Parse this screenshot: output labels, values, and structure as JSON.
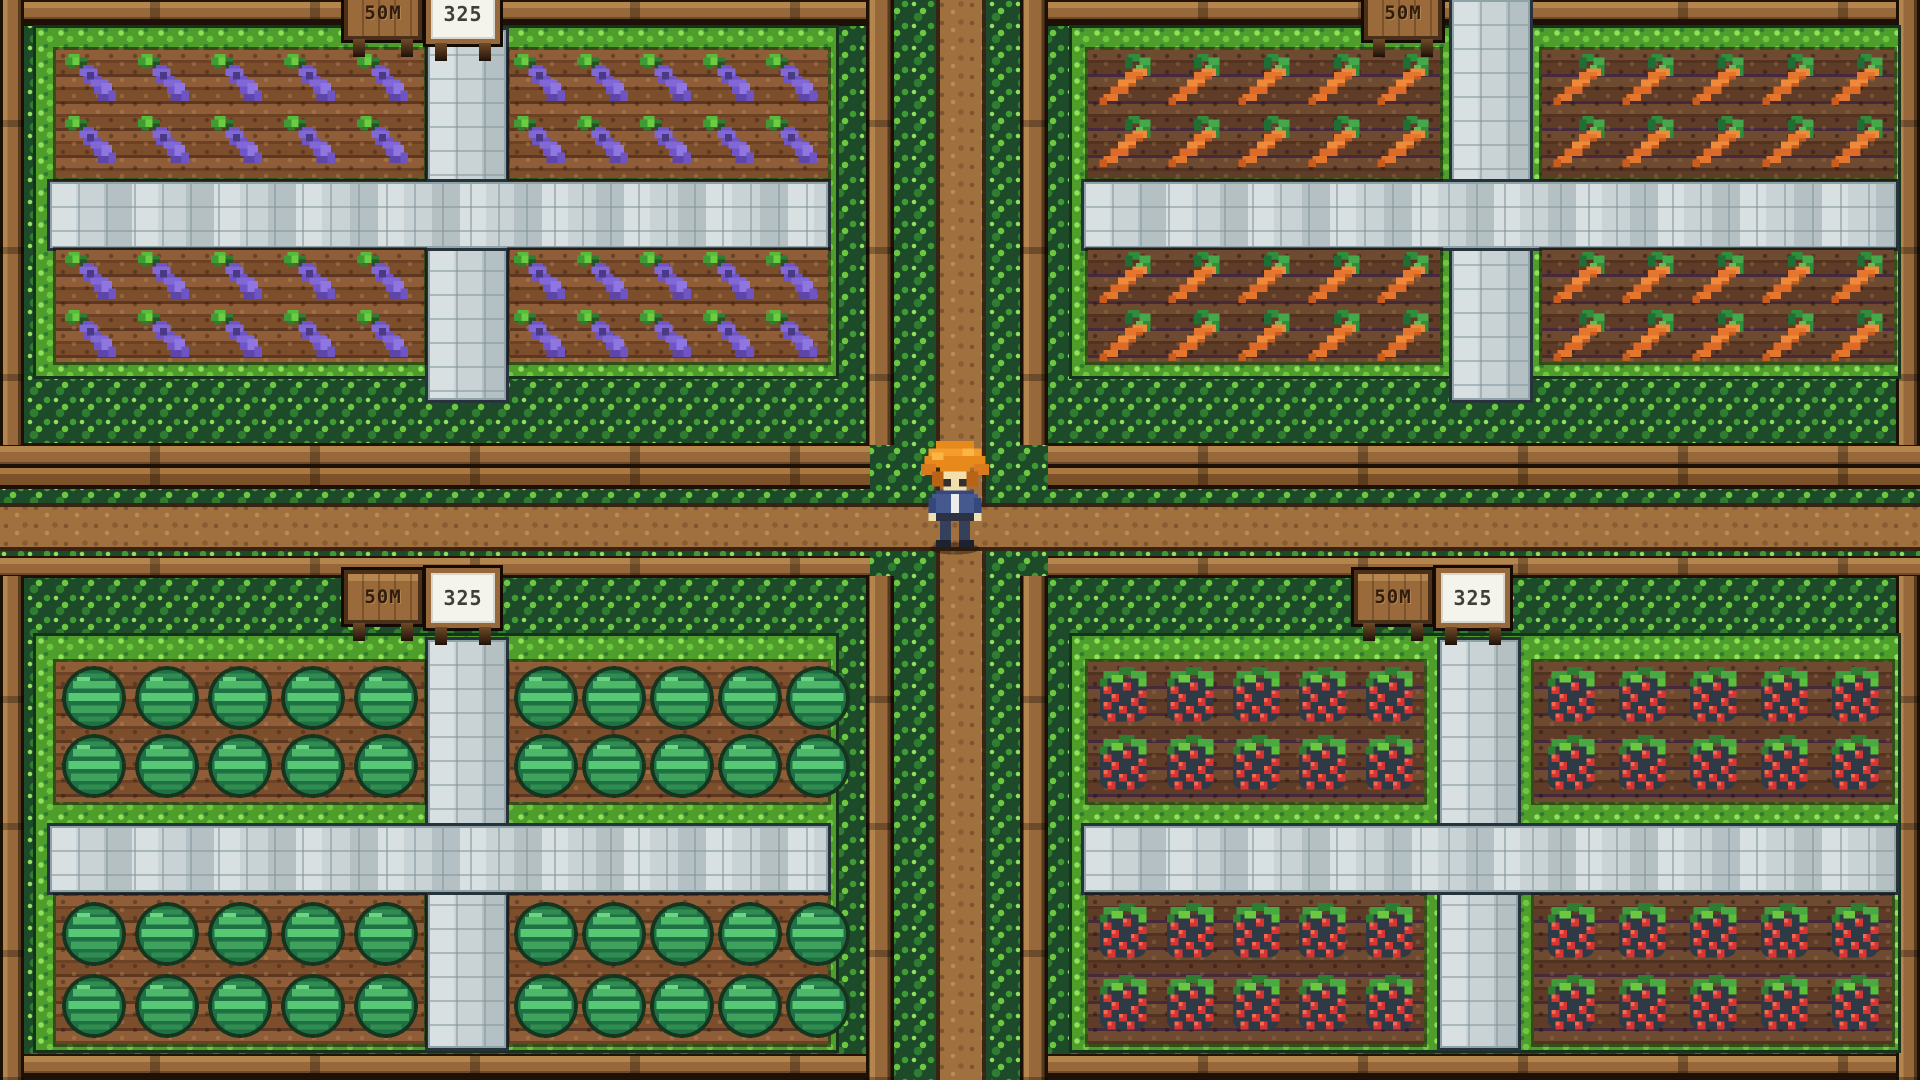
{
  "scene": {
    "type": "farming-game",
    "field_grid": {
      "subplots_per_quadrant": 4,
      "rows_per_subplot": 2,
      "cols_per_subplot": 5
    },
    "quadrants": [
      {
        "id": "top-left",
        "crop": "eggplant",
        "sign_time": "50M",
        "sign_price": "325"
      },
      {
        "id": "top-right",
        "crop": "carrot",
        "sign_time": "50M"
      },
      {
        "id": "bottom-left",
        "crop": "watermelon",
        "sign_time": "50M",
        "sign_price": "325"
      },
      {
        "id": "bottom-right",
        "crop": "strawberry",
        "sign_time": "50M",
        "sign_price": "325"
      }
    ],
    "character": {
      "role": "player-farmer",
      "hair": "orange",
      "outfit": "blue overalls with white shirt"
    },
    "palette": {
      "hedge_green": "#1d4a29",
      "leaf_green": "#6cc83e",
      "dirt_path": "#a1703f",
      "stone_path": "#c9d3d5",
      "fence_wood": "#96683a",
      "soil_warm": "#855331",
      "soil_dark": "#654233",
      "eggplant_purple": "#7a5fd0",
      "carrot_orange": "#e5762e",
      "watermelon_green": "#1f7045",
      "berry_red": "#d93434"
    }
  }
}
